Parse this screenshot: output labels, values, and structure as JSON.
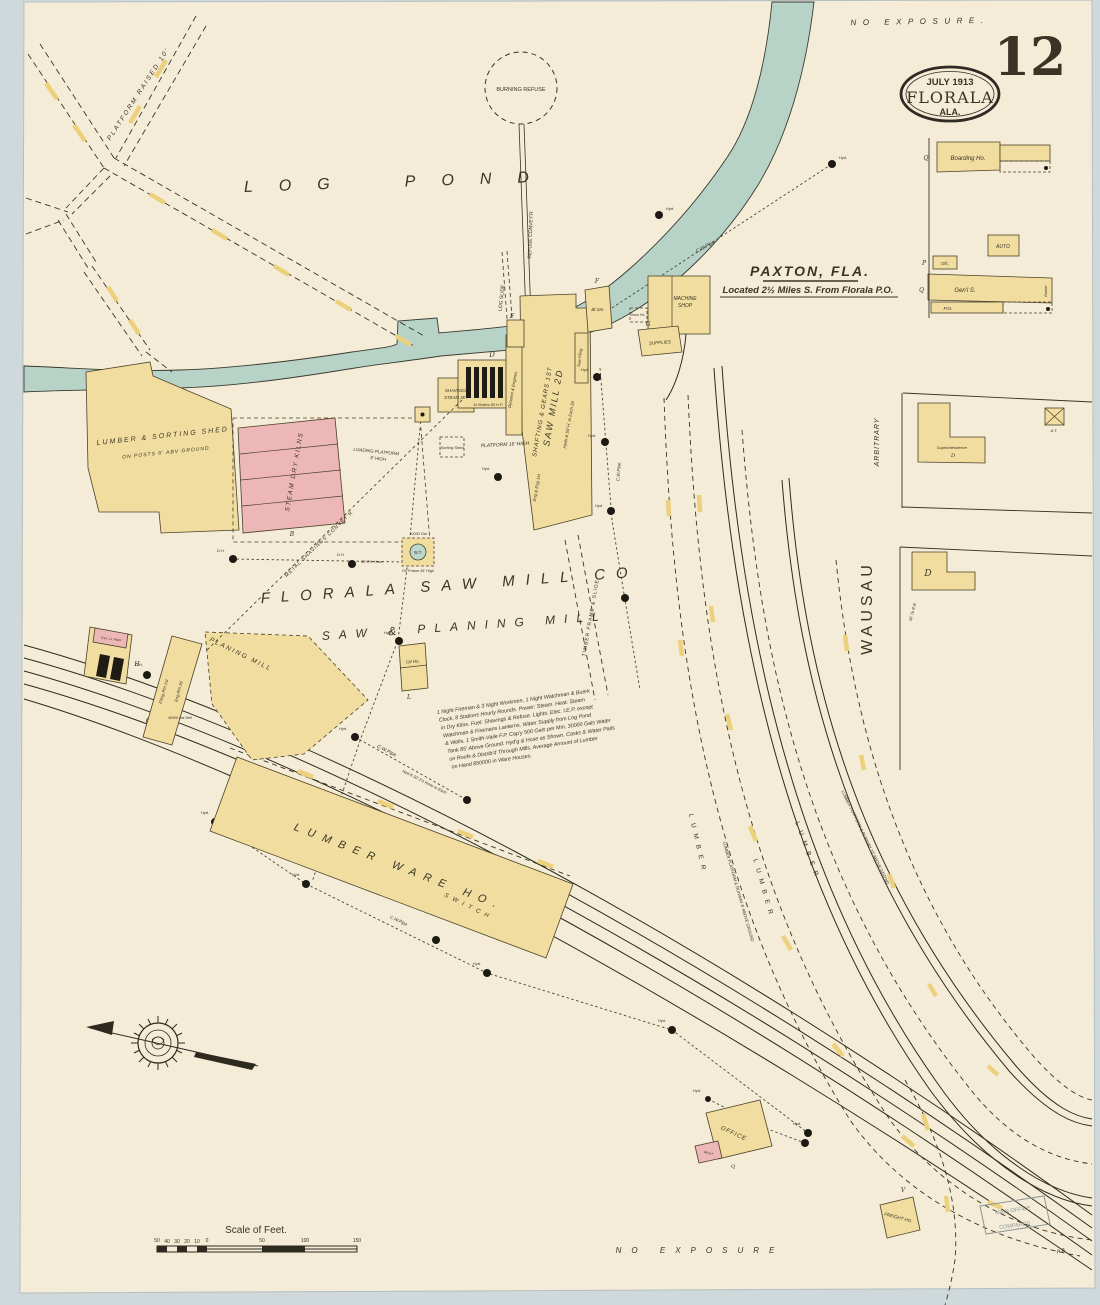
{
  "edition": {
    "page_number": "12",
    "date": "July 1913",
    "city": "Florala",
    "state": "Ala."
  },
  "exposure": {
    "top": "No Exposure.",
    "bottom": "No Exposure"
  },
  "places": {
    "log_pond_1": "Log",
    "log_pond_2": "Pond",
    "paxton_title": "Paxton, Fla.",
    "paxton_sub": "Located 2½ Miles S. From Florala P.O.",
    "company_1": "Florala Saw Mill Co",
    "company_2": "Saw & Planing Mill",
    "wausau": "Wausau",
    "arbitrary": "Arbitrary"
  },
  "features": {
    "burning_refuse": "Burning Refuse",
    "refuse_conveyor": "Refuse Convey'r",
    "log_slide": "Log Slide",
    "platform_raised": "Platform Raised 10'",
    "metal_shavings_conveyor": "Metal Shavings Convey'r",
    "timber_frame_slide": "Timber Frame & Slide",
    "switch": "Switch",
    "lumber": "Lumber",
    "lumber_platform_8": "Lumber Platform & Runway 8' Above Ground",
    "lumber_platform_10": "Lumber Platform & Runway 10' Above Gro'nd",
    "cw_pipe": "C.W.Pipe",
    "hyd": "Hyd.",
    "dh": "D.H.",
    "hose_note": "Hyd & 50' 2½ Hose to Each",
    "hose_short": "50' 2½ Hose",
    "well": "40000 Gal Well",
    "to_rr": "30' To R.R."
  },
  "buildings": {
    "boarding_ho": "Boarding Ho.",
    "auto": "Auto",
    "ofc": "Ofc.",
    "genl_s": "Gen'l S.",
    "barber": "Barber",
    "po": "P.O.",
    "superintendence": "Superintendence",
    "at": "A.T.",
    "machine_shop_1": "Machine",
    "machine_shop_2": "Shop",
    "bl_sm": "Bl.Sm.",
    "supplies": "Supplies",
    "drum_ho": "Drum Ho.",
    "saw_filing": "Saw Filing",
    "dynamo": "Dynamo & Engines",
    "mill_1": "Saw Mill 2d",
    "mill_2": "Shafting & Gears 1st",
    "mill_3": "Hyds & 50' H. to Each 2d",
    "mill_4": "Eng & Eng 1st",
    "boilers": "14 Boilers 80 H.P.",
    "shavings_1": "Shavings",
    "shavings_2": "Steam Jet",
    "sorting_shed": "Sorting Shed",
    "platform_16": "Platform 16' High",
    "loading_platform_1": "Loading Platform",
    "loading_platform_2": "8' High",
    "lumber_shed_1": "Lumber & Sorting Shed",
    "lumber_shed_2": "On Posts 8' Abv Ground",
    "dry_kilns": "Steam Dry Kilns",
    "wt_1": "10000 Gal",
    "wt_2": "W.T.",
    "wt_3": "On Frame 45' High",
    "planing_mill": "Planing Mill",
    "filing_rm_1": "Filing Rm 1st",
    "filing_rm_2": "Eng Rm 2d",
    "elec_plant": "Elec. Lt. Plant",
    "oil_ho": "Oil Ho.",
    "ware_ho": "Lumber Ware Ho.",
    "office": "Office",
    "vault": "Vault",
    "freight_ho": "Freight Ho.",
    "letter_f": "F",
    "letter_g": "G",
    "letter_h": "H",
    "letter_l": "L",
    "letter_b": "B",
    "letter_p": "P",
    "letter_q": "Q.",
    "letter_q2": "Q",
    "letter_v": "V",
    "letter_d": "D",
    "letter_d2": "D"
  },
  "notes": {
    "title_lines": [
      "1 Night Fireman & 3 Night Workmen, 1 Night Watchman & Buerk",
      "Clock, 8 Stations Hourly Rounds. Power: Steam. Heat: Steam",
      "in Dry Kilns. Fuel: Shavings & Refuse. Lights: Elec. I.E.P. except",
      "Watchman & Firemans Lanterns. Water Supply from Log Pond",
      "& Wells. 1 Smith-Vaile F.P. Cap'y 500 Gals per Min. 30000 Gals Water",
      "Tank 85' Above Ground. Hyd'g & Hose as Shown. Casks & Water Pails",
      "on Roofs & Distrib'd Through Mills. Average Amount of Lumber",
      "on Hand 850000 in Ware Houses."
    ]
  },
  "scale": {
    "title": "Scale of Feet.",
    "ticks": [
      "50",
      "40",
      "30",
      "20",
      "10",
      "0",
      "50",
      "100",
      "150"
    ]
  },
  "stamp": {
    "line1": "Main Office",
    "line2": "Compared",
    "initials": "R.B."
  },
  "colors": {
    "paper": "#f4ecd6",
    "margin": "#cfd8db",
    "building_yellow": "#f1dda0",
    "building_pink": "#edb7b8",
    "water": "#b7d3c8",
    "ink": "#3a3424",
    "tie_yellow": "#ecd07c"
  }
}
